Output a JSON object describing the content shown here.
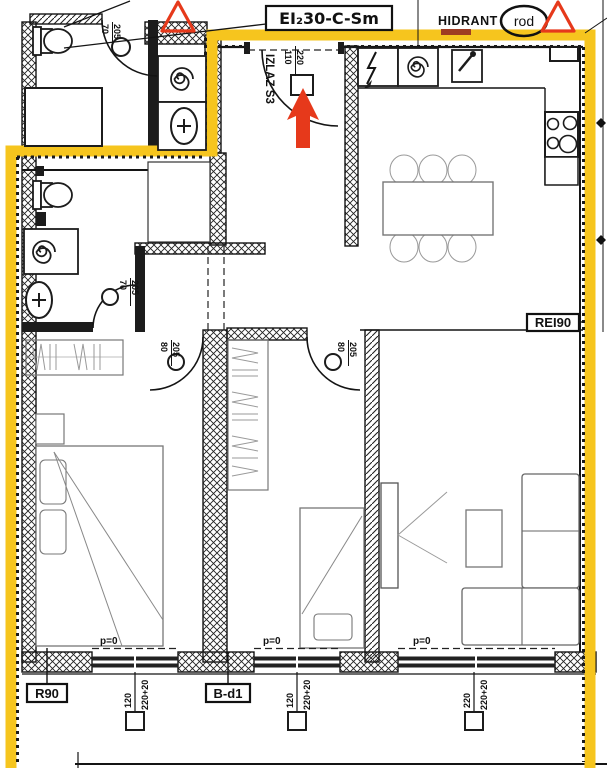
{
  "colors": {
    "escape_route_yellow": "#F6C51E",
    "alarm_red": "#E6391B"
  },
  "labels": {
    "fire_door_rating": "EI₂30-C-Sm",
    "hydrant": "HIDRANT",
    "shaft": "rod",
    "exit": "IZLAZ S3",
    "wall_rating": "REI90",
    "slab_rating": "R90",
    "balcony_door": "B-d1"
  },
  "doors": [
    {
      "name": "upper-bathroom-door",
      "width": "70",
      "height": "205"
    },
    {
      "name": "lower-bathroom-door",
      "width": "70",
      "height": "205"
    },
    {
      "name": "bedroom1-door",
      "width": "80",
      "height": "205"
    },
    {
      "name": "bedroom2-door",
      "width": "80",
      "height": "205"
    },
    {
      "name": "exit-door",
      "width": "110",
      "height": "220"
    }
  ],
  "windows": [
    {
      "name": "bedroom1-window",
      "width": "120",
      "height": "220+20",
      "parapet": "p=0"
    },
    {
      "name": "bedroom2-window",
      "width": "120",
      "height": "220+20",
      "parapet": "p=0"
    },
    {
      "name": "living-room-window",
      "width": "220",
      "height": "220+20",
      "parapet": "p=0"
    }
  ]
}
